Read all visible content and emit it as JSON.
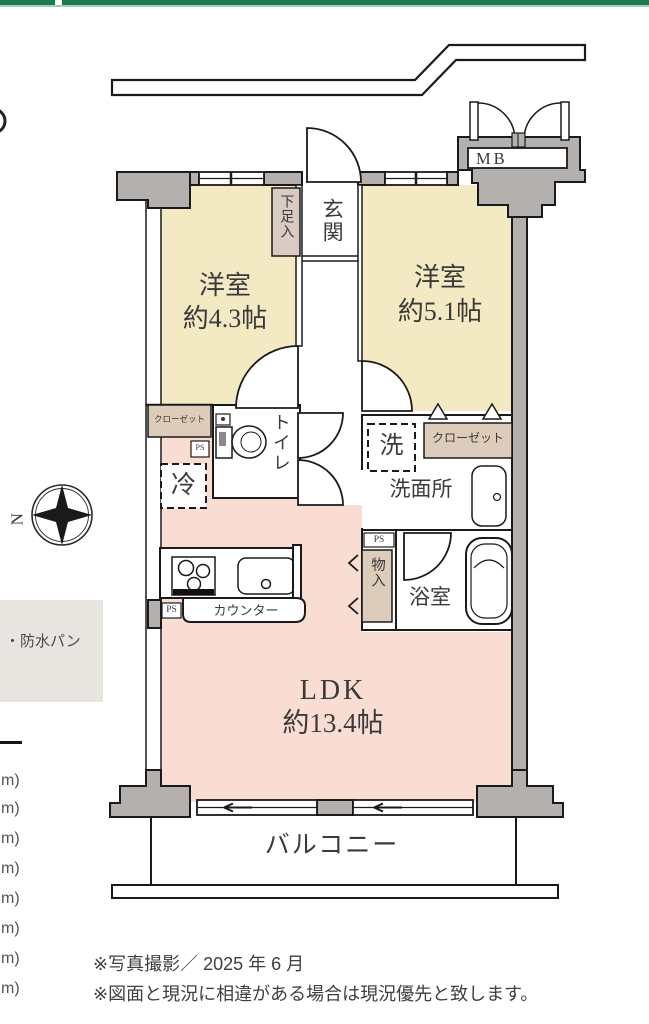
{
  "plan": {
    "rooms": {
      "bedroom1": {
        "name": "洋室",
        "size": "約4.3帖"
      },
      "bedroom2": {
        "name": "洋室",
        "size": "約5.1帖"
      },
      "ldk": {
        "name": "LDK",
        "size": "約13.4帖"
      },
      "entrance": "玄関",
      "shoe_box": "下足入",
      "toilet": "トイレ",
      "washer": "洗",
      "washroom": "洗面所",
      "bath": "浴室",
      "storage": "物入",
      "fridge": "冷",
      "closet_left": "クローゼット",
      "closet_right": "クローゼット",
      "counter": "カウンター",
      "balcony": "バルコニー",
      "meter_box": "MB",
      "ps": "PS"
    }
  },
  "compass": {
    "label": "N"
  },
  "legend_box": {
    "text": "・防水パン"
  },
  "left_fragments": [
    "m)",
    "m)",
    "m)",
    "m)",
    "m)",
    "m)",
    "m)",
    "m)"
  ],
  "notes": {
    "line1": "※写真撮影／ 2025 年 6 月",
    "line2": "※図面と現況に相違がある場合は現況優先と致します。"
  },
  "colors": {
    "brand_green": "#1d7a4e",
    "brand_green_light": "#9ed0b5",
    "wall_gray": "#b3b0ad",
    "bedroom_yellow": "#f3e9c2",
    "ldk_pink": "#f9dcd2",
    "closet_tan": "#ddccb9",
    "legend_gray": "#e8e4e0"
  }
}
